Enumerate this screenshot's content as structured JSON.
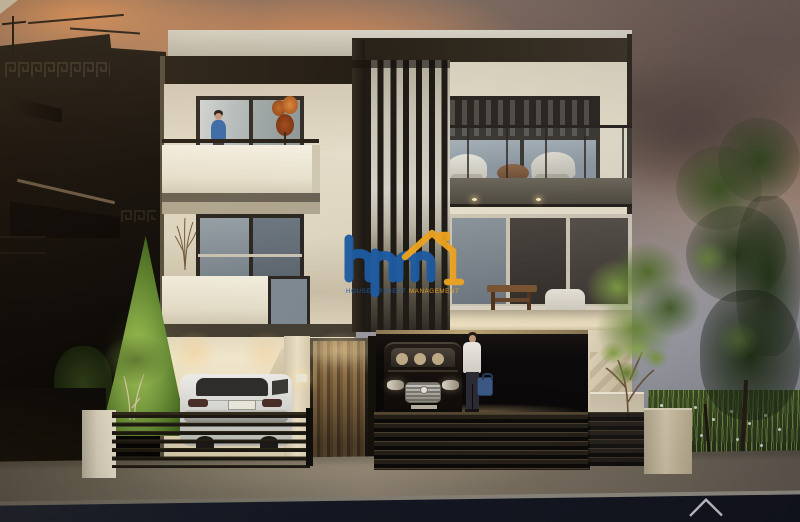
{
  "watermark": {
    "logo_text": "hpm",
    "tagline_left": "HOUSE PROJECT",
    "tagline_right": "MANAGEMENT",
    "blue": "#1e5ca3",
    "yellow": "#f0a620"
  },
  "road_mark": {
    "shape": "house-roof-outline",
    "color": "#ffffff"
  },
  "scene": {
    "description_labels": {
      "building": "three-storey-modern-residence",
      "time_of_day": "dusk"
    },
    "palette": {
      "sky_warm": "#c98e66",
      "sky_grey": "#7c7270",
      "wall_cream": "#e9e2cf",
      "fascia_dark": "#2a241d",
      "slat_dark": "#241f19",
      "foliage_bright": "#7fa441",
      "foliage_dark": "#33431f",
      "road_dark": "#161a22",
      "sidewalk": "#7d766a",
      "gate_wood": "#8f7148",
      "glow_warm": "#ffd998"
    }
  }
}
